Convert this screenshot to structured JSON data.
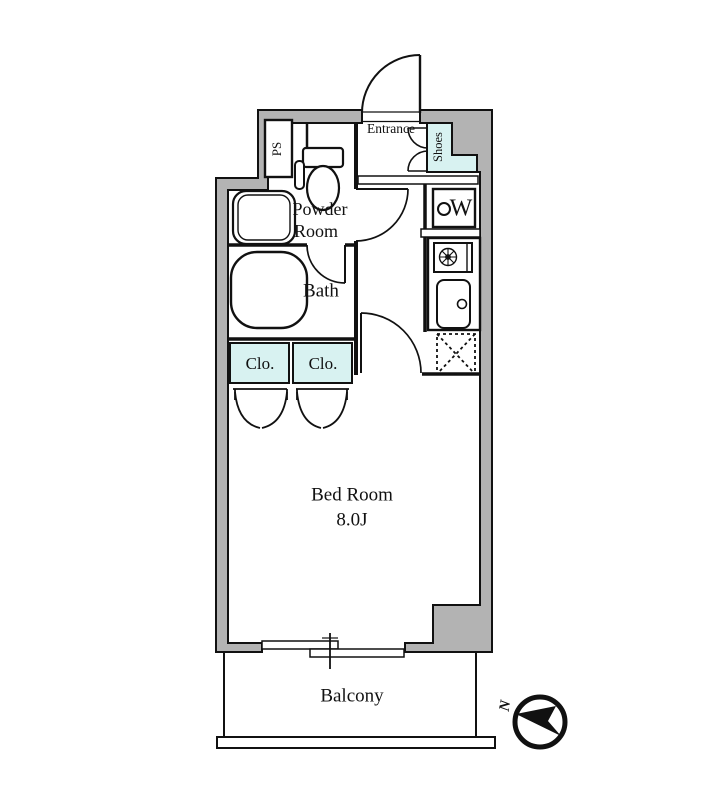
{
  "floor_plan": {
    "rooms": {
      "entrance": "Entrance",
      "shoes": "Shoes",
      "ps": "PS",
      "powder_room": {
        "line1": "Powder",
        "line2": "Room"
      },
      "bath": "Bath",
      "closet_left": "Clo.",
      "closet_right": "Clo.",
      "bedroom": {
        "name": "Bed Room",
        "size": "8.0J"
      },
      "balcony": "Balcony"
    },
    "fixtures": {
      "washing_machine": "W"
    },
    "compass": {
      "north": "N"
    },
    "colors": {
      "wall_gray": "#b3b3b3",
      "highlight_cyan": "#d8f2f1",
      "line_black": "#111111",
      "background": "#ffffff"
    }
  }
}
